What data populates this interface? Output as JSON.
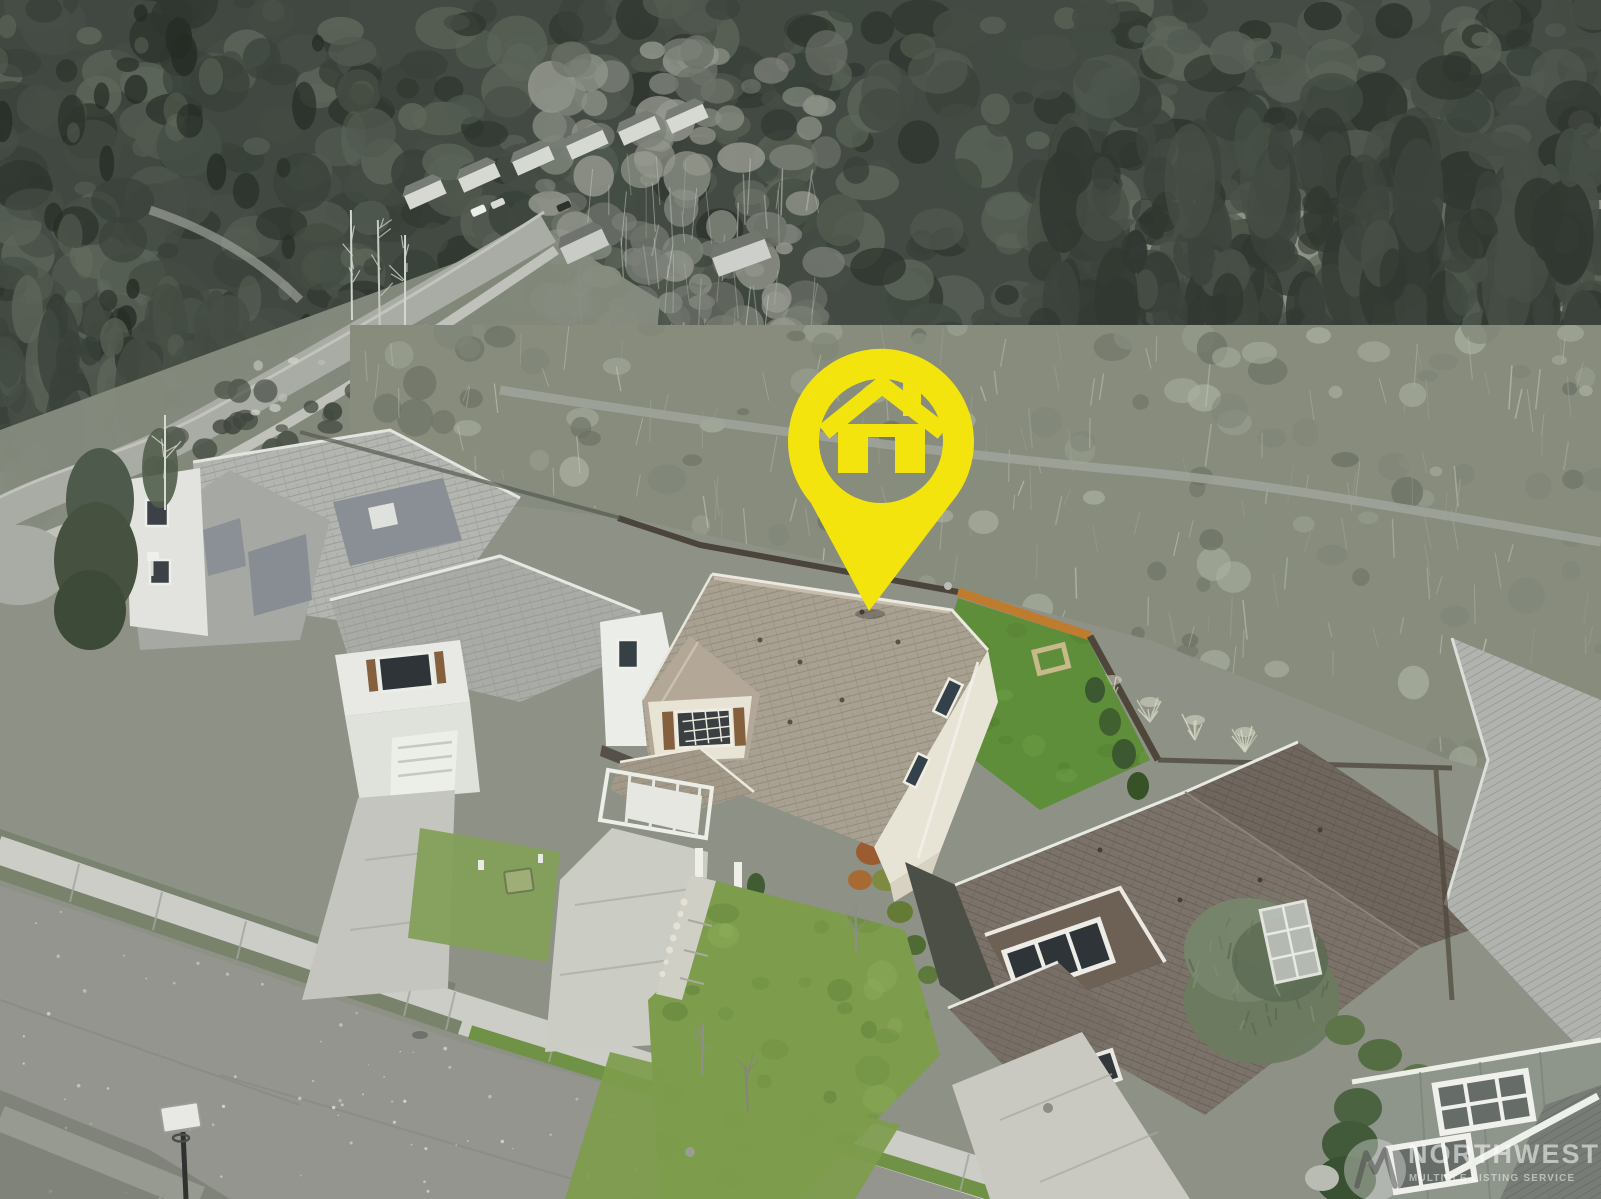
{
  "image": {
    "kind": "real-estate aerial drone photo",
    "alt": "Aerial drone view of a two-story suburban home marked with a yellow house-shaped location pin; neighboring homes line the street, a dense evergreen forest surrounds the neighborhood, and the subject property is shown in color while the rest of the scene is desaturated."
  },
  "marker": {
    "icon": "house-pin-icon",
    "color": "#F3E40E"
  },
  "watermark": {
    "logo": "nwmls-logo",
    "line1": "NORTHWEST",
    "line2": "MULTIPLE LISTING SERVICE",
    "text_color": "rgba(255,255,255,0.55)"
  },
  "palette": {
    "pin_yellow": "#F3E40E",
    "sky": "#D8DBD5",
    "forest_dark": "#3C433C",
    "scrub": "#8A8F81",
    "asphalt": "#92948E",
    "concrete": "#CBCCC5",
    "roof_taupe": "#A8A090",
    "roof_brown": "#7B7369",
    "siding_cream": "#E7E3D5",
    "lawn_front": "#7D9C4C",
    "lawn_back": "#5F8E3A",
    "lawn_strip": "#6F9246",
    "fence_orange": "#BF7B2E",
    "shutter_brown": "#84603F",
    "cedar_green": "#76846B",
    "conifer_green": "#4B6340",
    "watermark_white": "rgba(255,255,255,0.55)"
  }
}
